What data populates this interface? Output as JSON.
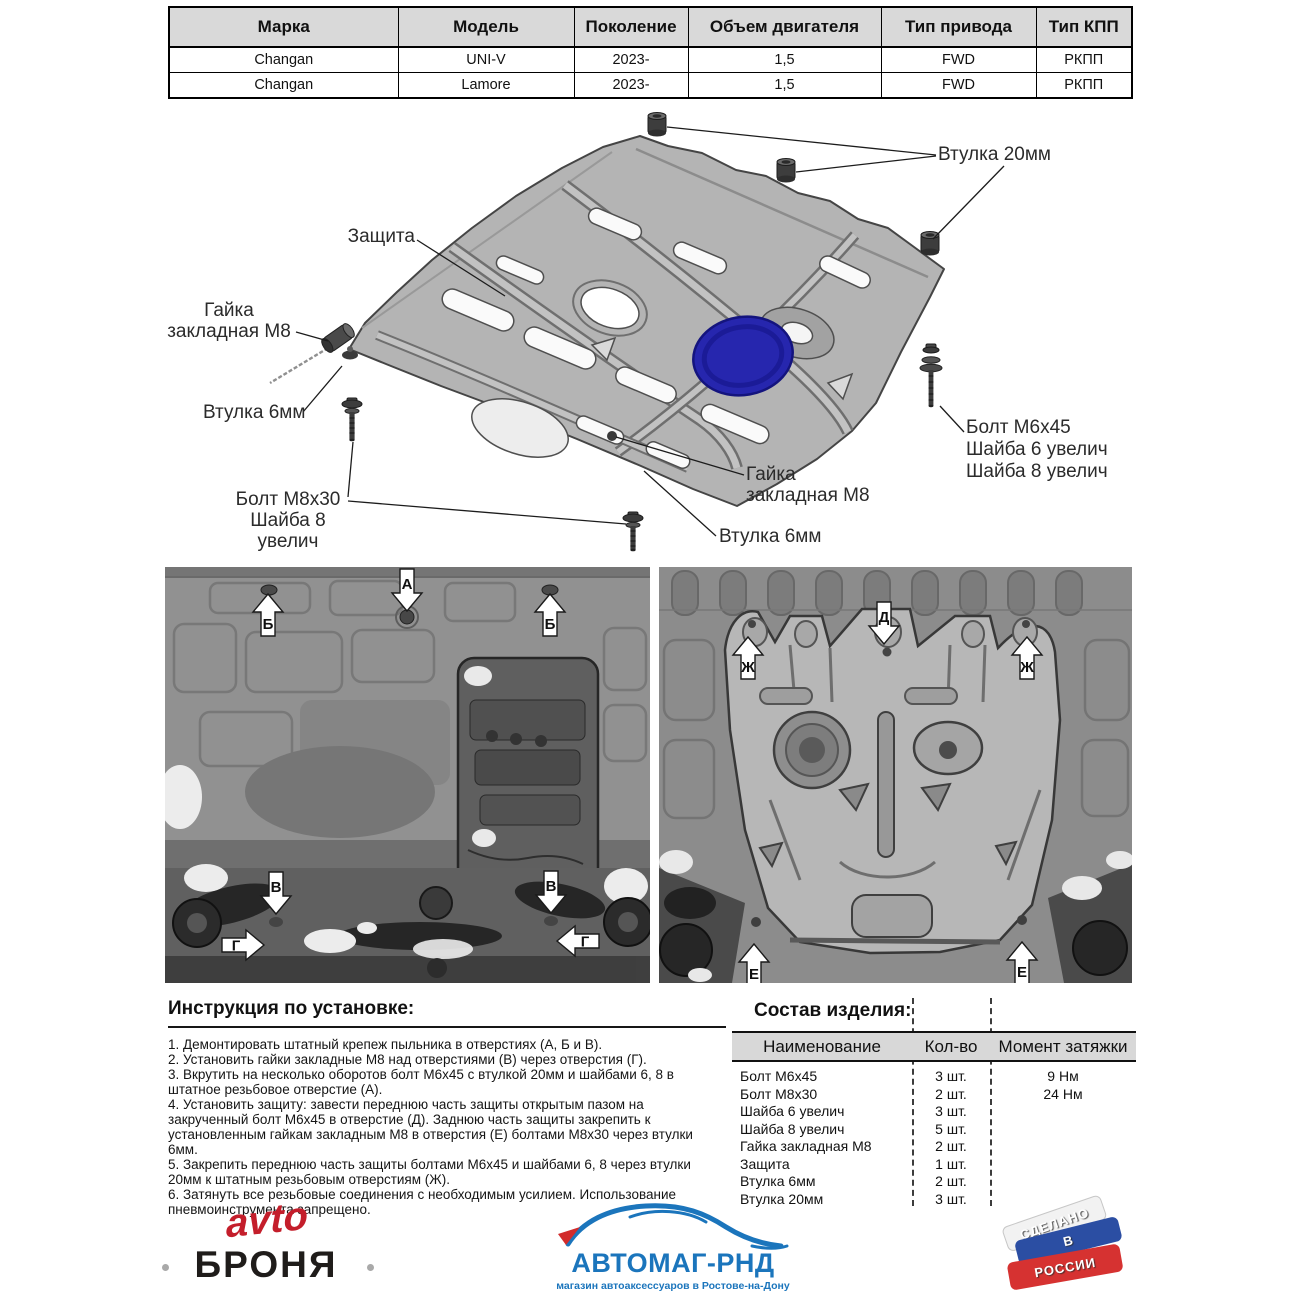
{
  "fitment_table": {
    "headers": [
      "Марка",
      "Модель",
      "Поколение",
      "Объем двигателя",
      "Тип привода",
      "Тип КПП"
    ],
    "rows": [
      [
        "Changan",
        "UNI-V",
        "2023-",
        "1,5",
        "FWD",
        "РКПП"
      ],
      [
        "Changan",
        "Lamore",
        "2023-",
        "1,5",
        "FWD",
        "РКПП"
      ]
    ]
  },
  "diagram": {
    "labels": {
      "zashchita": "Защита",
      "vtulka20": "Втулка 20мм",
      "gayka_left_1": "Гайка",
      "gayka_left_2": "закладная М8",
      "vtulka6_left": "Втулка 6мм",
      "bolt_m8x30_1": "Болт М8х30",
      "bolt_m8x30_2": "Шайба 8 увелич",
      "bolt_m6x45_1": "Болт М6х45",
      "bolt_m6x45_2": "Шайба 6 увелич",
      "bolt_m6x45_3": "Шайба 8 увелич",
      "gayka_bottom_1": "Гайка",
      "gayka_bottom_2": "закладная М8",
      "vtulka6_bottom": "Втулка 6мм"
    }
  },
  "photos": {
    "left": {
      "markers": [
        "Б",
        "А",
        "Б",
        "В",
        "В",
        "Г",
        "Г"
      ]
    },
    "right": {
      "markers": [
        "Д",
        "Ж",
        "Ж",
        "Е",
        "Е"
      ]
    }
  },
  "instructions": {
    "title": "Инструкция по установке:",
    "items": [
      "1. Демонтировать штатный крепеж пыльника в отверстиях (А, Б и В).",
      "2. Установить гайки закладные М8 над отверстиями (В) через отверстия (Г).",
      "3. Вкрутить на несколько оборотов болт М6х45 с втулкой 20мм и шайбами 6, 8 в штатное резьбовое отверстие (А).",
      "4. Установить защиту: завести переднюю часть защиты открытым пазом на закрученный болт М6х45 в отверстие (Д). Заднюю часть защиты закрепить к установленным гайкам закладным М8 в отверстия (Е) болтами М8х30 через втулки 6мм.",
      "5. Закрепить переднюю часть защиты болтами М6х45 и шайбами 6, 8 через втулки 20мм к штатным резьбовым отверстиям (Ж).",
      "6. Затянуть все резьбовые соединения с необходимым усилием. Использование пневмоинструмента запрещено."
    ]
  },
  "parts": {
    "title": "Состав изделия:",
    "headers": [
      "Наименование",
      "Кол-во",
      "Момент затяжки"
    ],
    "rows": [
      [
        "Болт М6х45",
        "3 шт.",
        "9 Нм"
      ],
      [
        "Болт М8х30",
        "2 шт.",
        "24 Нм"
      ],
      [
        "Шайба 6 увелич",
        "3 шт.",
        ""
      ],
      [
        "Шайба 8 увелич",
        "5 шт.",
        ""
      ],
      [
        "Гайка закладная М8",
        "2 шт.",
        ""
      ],
      [
        "Защита",
        "1 шт.",
        ""
      ],
      [
        "Втулка 6мм",
        "2 шт.",
        ""
      ],
      [
        "Втулка 20мм",
        "3 шт.",
        ""
      ]
    ]
  },
  "logos": {
    "avtobronya": {
      "line1": "avto",
      "line2": "БРОНЯ"
    },
    "avtomag": {
      "name": "АВТОМАГ-РНД",
      "subtitle": "магазин автоаксессуаров в Ростове-на-Дону"
    },
    "stamp": {
      "line1": "СДЕЛАНО",
      "line2": "В",
      "line3": "РОССИИ"
    }
  },
  "colors": {
    "table_header_bg": "#d9d9d9",
    "plate_gray": "#b4b4b4",
    "plate_blue": "#2626ae",
    "logo_red": "#c41e2b",
    "logo_blue": "#1b75bc",
    "flag_blue": "#2b4ea3",
    "flag_red": "#d63231"
  }
}
